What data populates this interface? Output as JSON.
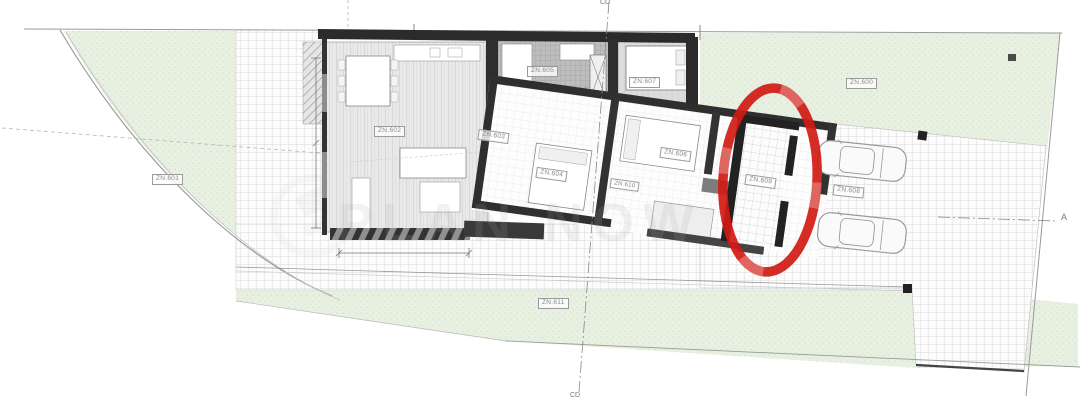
{
  "plan": {
    "zones": {
      "z600": "ZN.600",
      "z601": "ZN.601",
      "z602": "ZN.602",
      "z603": "ZN.603",
      "z604": "ZN.604",
      "z605": "ZN.605",
      "z606": "ZN.606",
      "z607": "ZN.607",
      "z608": "ZN.608",
      "z609": "ZN.609",
      "z610": "ZN.610",
      "z611": "ZN.611"
    },
    "markers": {
      "section_a": "A",
      "section_cd_top": "CD",
      "section_cd_bottom": "CD"
    },
    "watermark": {
      "text": "PLAN NOW"
    },
    "annotation": {
      "shape": "ellipse",
      "color": "#d11a12"
    },
    "colors": {
      "grass": "#e7f0e1",
      "wall": "#2b2b2b",
      "annotation_red": "#d11a12"
    }
  }
}
